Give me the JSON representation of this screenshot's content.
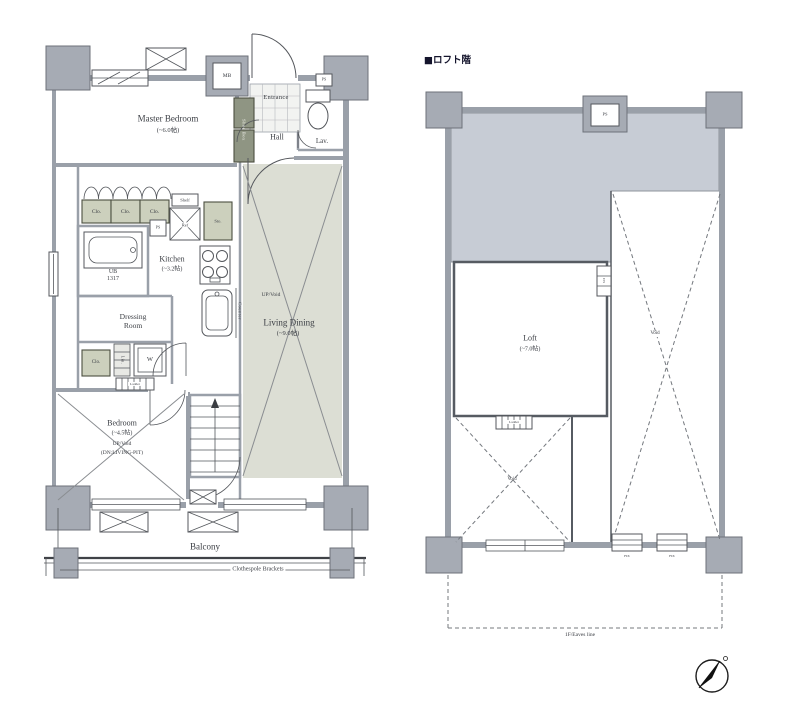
{
  "title": {
    "loft_header": "■ロフト階"
  },
  "left_plan": {
    "rooms": {
      "master_bedroom": {
        "name": "Master Bedroom",
        "size": "(~6.0帖)"
      },
      "entrance": "Entrance",
      "hall": "Hall",
      "lavatory": "Lav.",
      "kitchen": {
        "name": "Kitchen",
        "size": "(~3.2帖)"
      },
      "living_dining": {
        "name": "Living Dining",
        "size": "(~9.0帖)",
        "note": "UP/Void"
      },
      "dressing_room": "Dressing\nRoom",
      "bathroom": "UB\n1317",
      "bedroom": {
        "name": "Bedroom",
        "size": "(~4.5帖)",
        "note1": "UP/Void",
        "note2": "(DN:LIVING-PIT)"
      },
      "balcony": "Balcony"
    },
    "fixtures": {
      "meter_box": "MB",
      "pipe_space_top": "PS",
      "shoe_box": "Shoe Box",
      "closet_1": "Clo.",
      "closet_2": "Clo.",
      "closet_3": "Clo.",
      "shelf": "Shelf",
      "refrigerator": "Ref",
      "pipe_space_kitchen": "PS",
      "storage": "Sto.",
      "counter": "Counter",
      "washer": "W",
      "linen": "Lin.",
      "closet_4": "Clo.",
      "ladder": "Ladder",
      "clothespole": "Clothespole Brackets"
    }
  },
  "right_plan": {
    "rooms": {
      "loft": {
        "name": "Loft",
        "size": "(~7.0帖)"
      },
      "void_left": "Void",
      "void_right": "Void"
    },
    "fixtures": {
      "pipe_space": "PS",
      "duct_space": "DS",
      "ladder": "Ladder",
      "fix_window_1": "FIX",
      "fix_window_2": "FIX",
      "eaves_line": "1F/Eaves line"
    }
  }
}
